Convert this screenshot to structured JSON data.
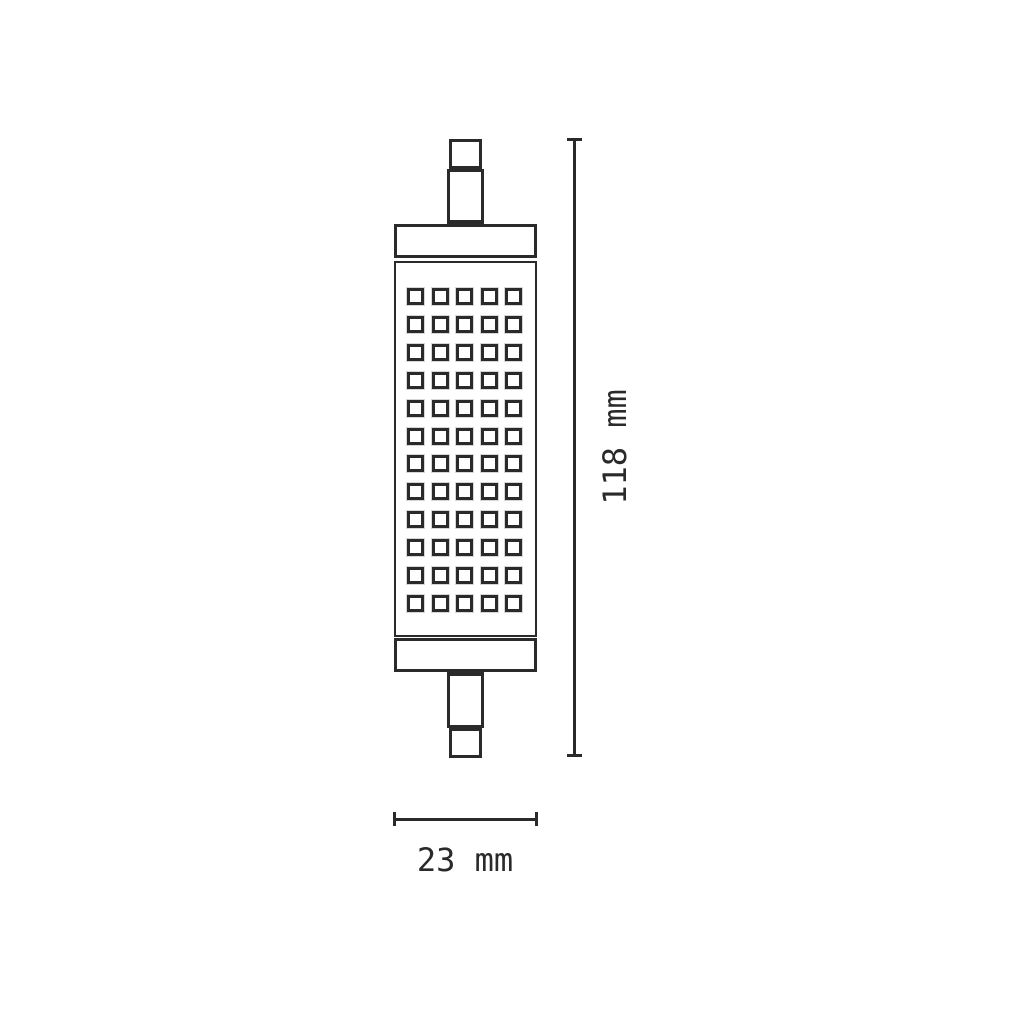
{
  "diagram": {
    "type": "technical-dimension-drawing",
    "line_color": "#2a2a2a",
    "background_color": "#ffffff",
    "lamp": {
      "led_grid": {
        "rows": 12,
        "columns": 5
      }
    },
    "dimensions": {
      "height": {
        "label": "118 mm",
        "value": 118,
        "unit": "mm",
        "orientation": "vertical"
      },
      "width": {
        "label": "23 mm",
        "value": 23,
        "unit": "mm",
        "orientation": "horizontal"
      }
    }
  }
}
